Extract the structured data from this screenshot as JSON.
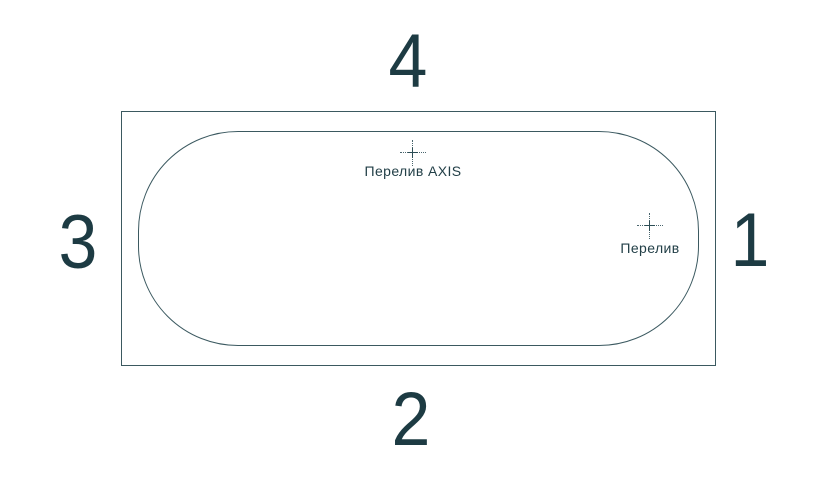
{
  "diagram": {
    "type": "bathtub-top-view",
    "sides": {
      "top": "4",
      "bottom": "2",
      "left": "3",
      "right": "1"
    },
    "markers": [
      {
        "icon": "crosshair-icon",
        "label": "Перелив AXIS",
        "position": "top-center"
      },
      {
        "icon": "crosshair-icon",
        "label": "Перелив",
        "position": "right-end"
      }
    ],
    "colors": {
      "background": "#ffffff",
      "line": "#3b5960",
      "text": "#1d3b43"
    }
  }
}
